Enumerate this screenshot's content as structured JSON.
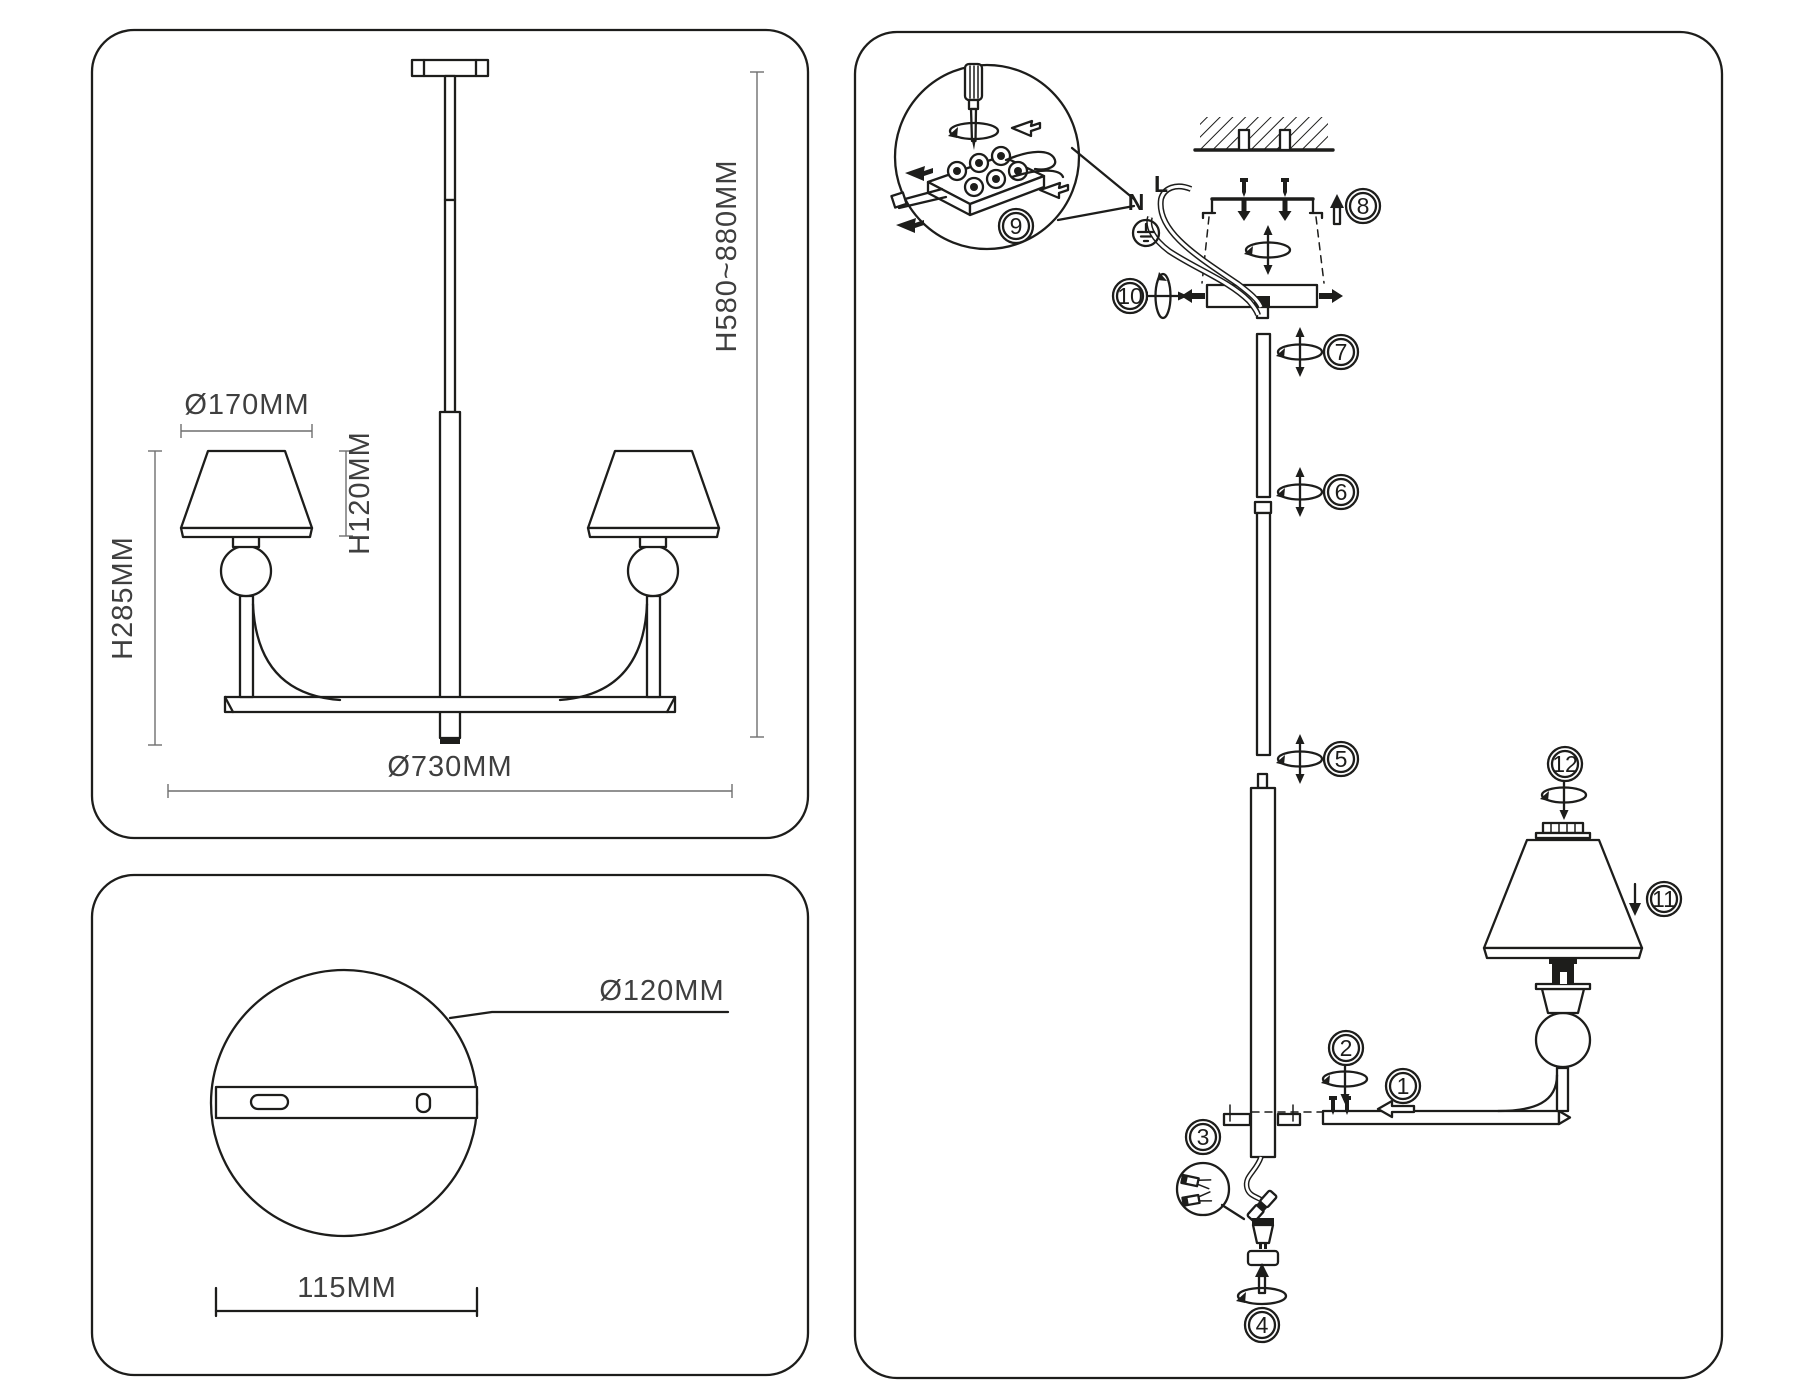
{
  "colors": {
    "ink": "#1d1d1b",
    "dim_text": "#3f3f3f",
    "background": "#ffffff"
  },
  "front_view": {
    "shade_diameter": "Ø170MM",
    "shade_height": "H120MM",
    "body_height": "H285MM",
    "fixture_diameter": "Ø730MM",
    "suspension_height": "H580~880MM"
  },
  "base_view": {
    "plate_diameter": "Ø120MM",
    "mount_spacing": "115MM"
  },
  "assembly": {
    "neutral_label": "N",
    "live_label": "L",
    "steps": [
      "1",
      "2",
      "3",
      "4",
      "5",
      "6",
      "7",
      "8",
      "9",
      "10",
      "11",
      "12"
    ]
  }
}
